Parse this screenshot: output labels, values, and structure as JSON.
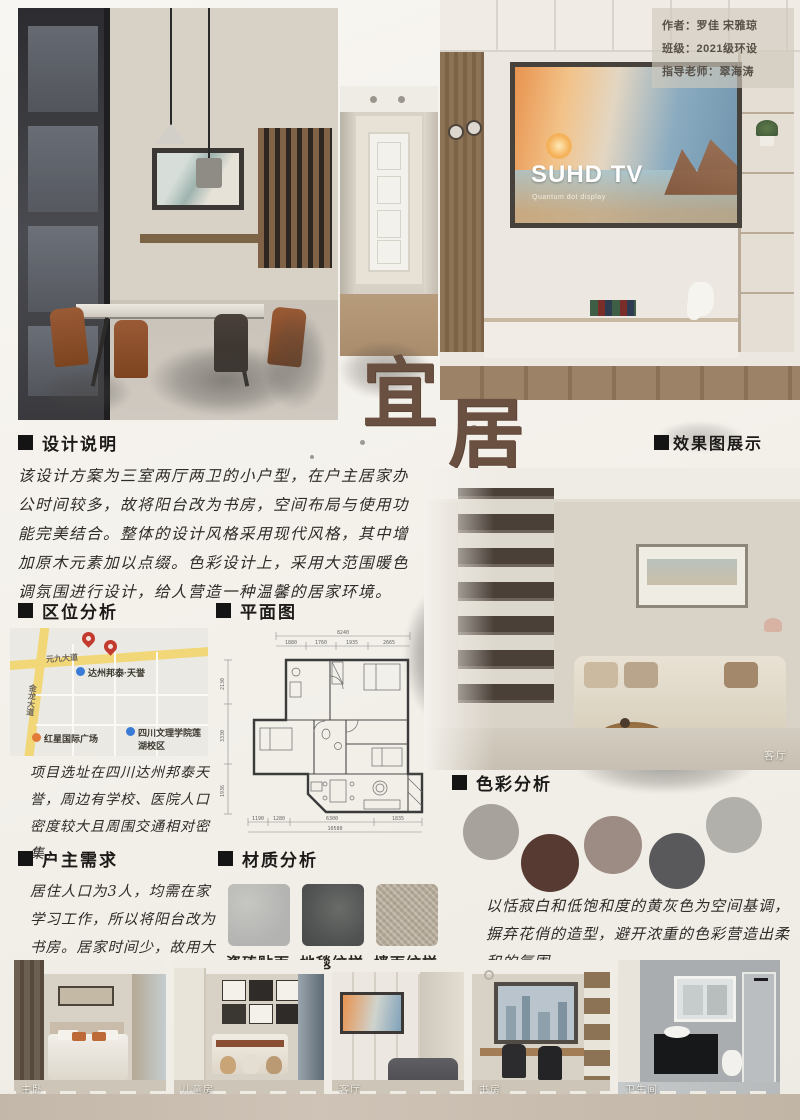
{
  "info_box": {
    "author": "作者：罗佳 宋雅琼",
    "class": "班级：2021级环设",
    "advisor": "指导老师：翠海涛"
  },
  "title": {
    "char1": "宜",
    "char2": "居"
  },
  "tv": {
    "brand": "SUHD TV",
    "subtitle": "Quantum dot display"
  },
  "sections": {
    "design": {
      "heading": "设计说明",
      "body": "该设计方案为三室两厅两卫的小户型，在户主居家办公时间较多，故将阳台改为书房，空间布局与使用功能完美结合。整体的设计风格采用现代风格，其中增加原木元素加以点缀。色彩设计上，采用大范围暖色调氛围进行设计，给人营造一种温馨的居家环境。"
    },
    "renders": {
      "heading": "效果图展示",
      "living_label": "客厅"
    },
    "location": {
      "heading": "区位分析",
      "body": "项目选址在四川达州邦泰天誉，周边有学校、医院人口密度较大且周围交通相对密集。",
      "map": {
        "road_h": "元九大道",
        "road_v": "金龙大道",
        "poi_main": "达州邦泰·天誉",
        "poi_plaza": "红星国际广场",
        "poi_college": "四川文理学院莲湖校区"
      }
    },
    "floorplan": {
      "heading": "平面图",
      "top_total": "8240",
      "top_segs": [
        "1880",
        "1760",
        "1935",
        "2665"
      ],
      "left_segs": [
        "2130",
        "3330",
        "1936"
      ],
      "bottom_segs": [
        "1190",
        "1280",
        "6300",
        "1835"
      ],
      "bottom_total": "10580"
    },
    "owner": {
      "heading": "户主需求",
      "body": "居住人口为3人，均需在家学习工作，所以将阳台改为书房。居家时间少，故用大量暖色，更显温馨。"
    },
    "materials": {
      "heading": "材质分析",
      "items": [
        {
          "label": "瓷砖贴面"
        },
        {
          "label": "地毯纹样"
        },
        {
          "label": "墙面纹样"
        }
      ]
    },
    "colors": {
      "heading": "色彩分析",
      "body": "以恬寂白和低饱和度的黄灰色为空间基调，摒弃花俏的造型，避开浓重的色彩营造出柔和的氛围。",
      "swatches": [
        {
          "hex": "#a7a29b"
        },
        {
          "hex": "#573a31"
        },
        {
          "hex": "#9d8c83"
        },
        {
          "hex": "#59595b"
        },
        {
          "hex": "#b2b0ab"
        }
      ]
    }
  },
  "bottom_photos": [
    {
      "label": "主卧"
    },
    {
      "label": "儿童房"
    },
    {
      "label": "客厅"
    },
    {
      "label": "书房"
    },
    {
      "label": "卫生间"
    }
  ]
}
